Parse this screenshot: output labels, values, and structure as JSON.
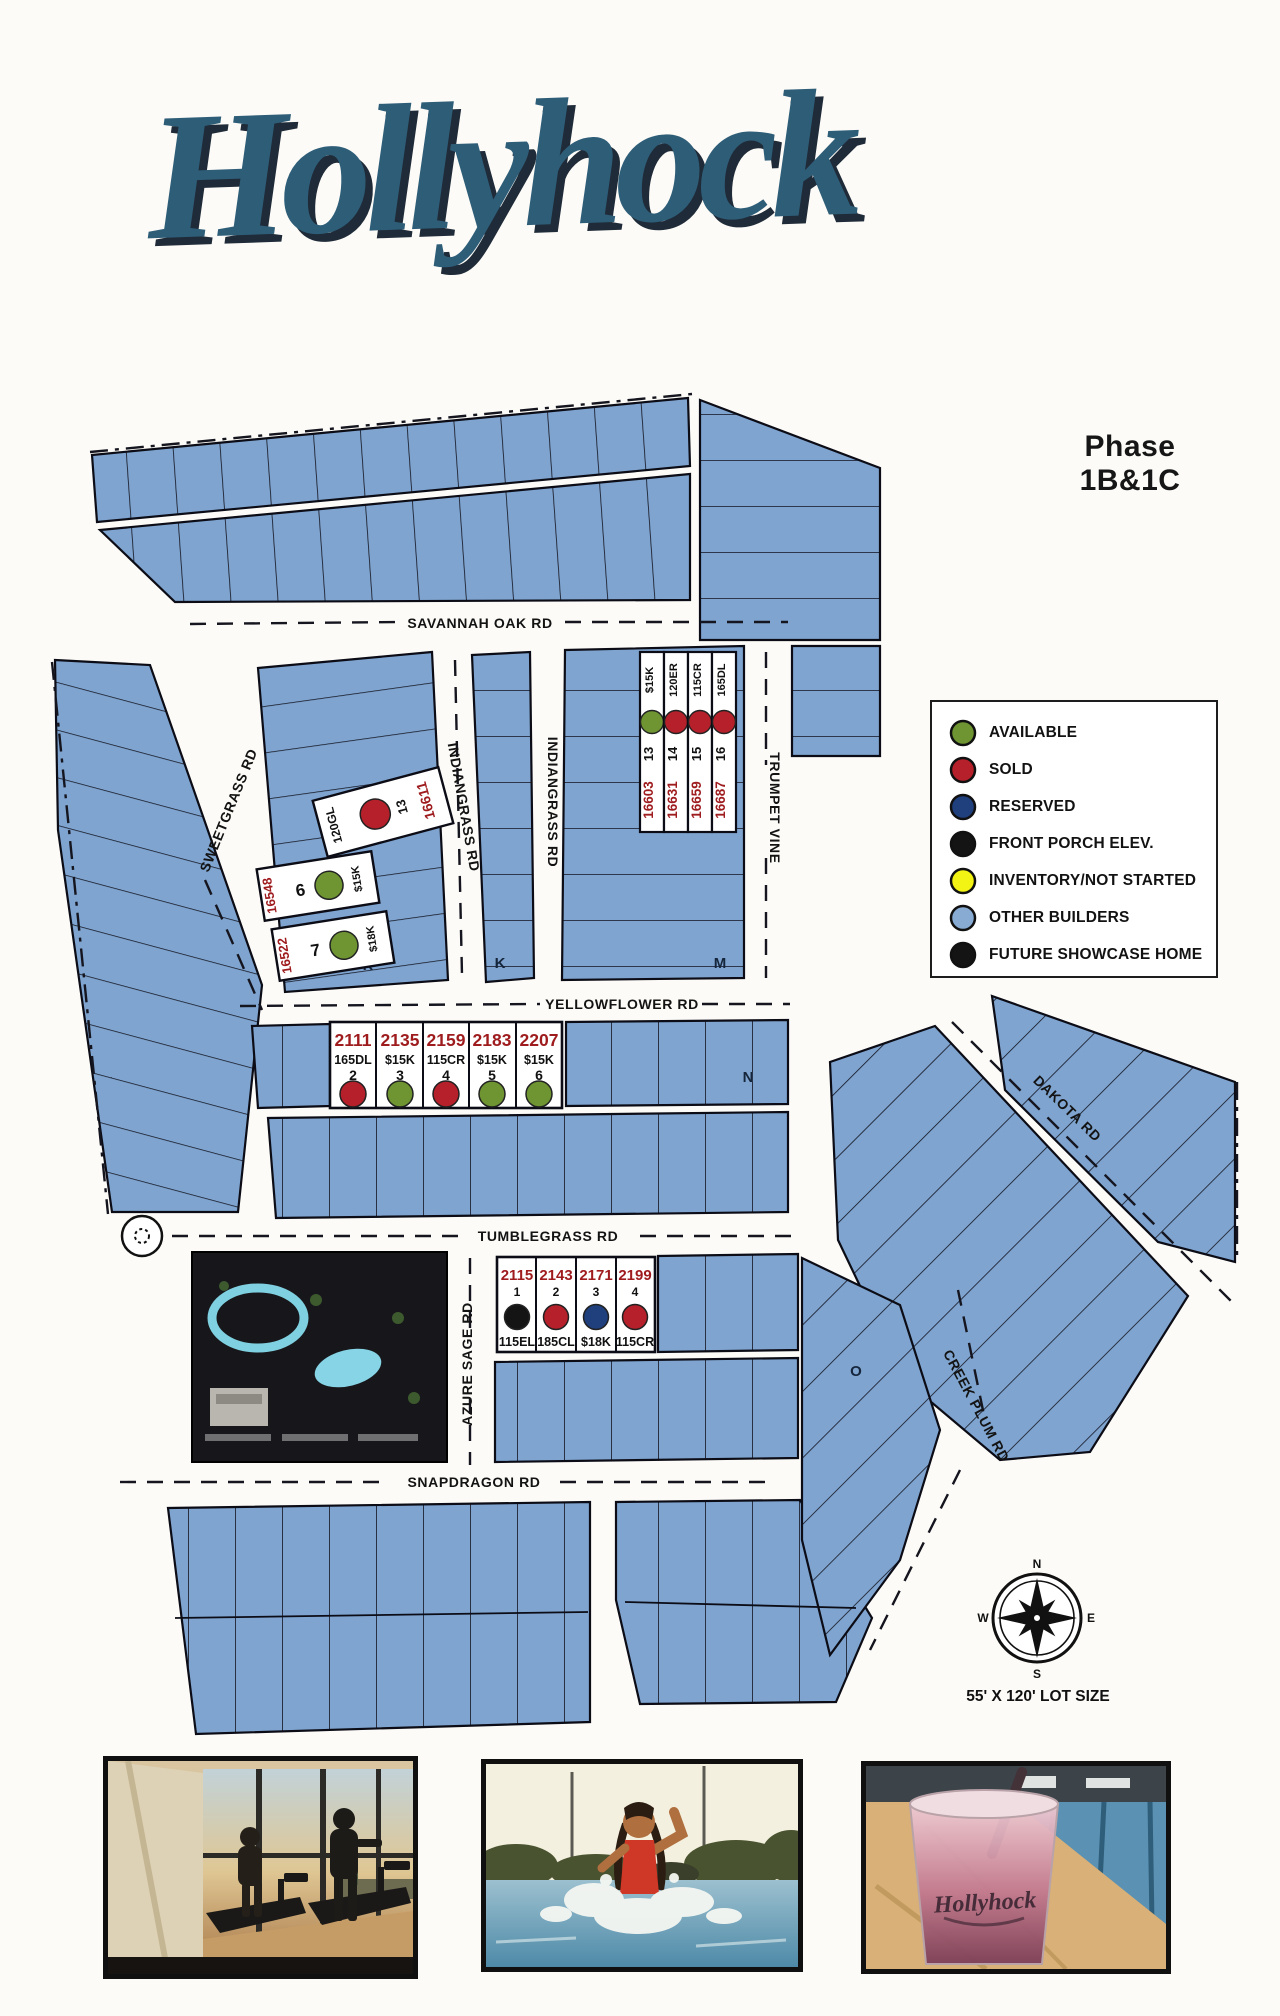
{
  "header": {
    "title": "Hollyhock",
    "phase": "Phase 1B&1C"
  },
  "legend": {
    "items": [
      {
        "label": "AVAILABLE",
        "color": "#6e9531"
      },
      {
        "label": "SOLD",
        "color": "#b5202a"
      },
      {
        "label": "RESERVED",
        "color": "#1f3f7d"
      },
      {
        "label": "FRONT PORCH ELEV.",
        "color": "#141414"
      },
      {
        "label": "INVENTORY/NOT STARTED",
        "color": "#f4f414"
      },
      {
        "label": "OTHER BUILDERS",
        "color": "#88abd3"
      },
      {
        "label": "FUTURE SHOWCASE HOME",
        "color": "#141414"
      }
    ]
  },
  "map": {
    "streets": {
      "savannah_oak": "SAVANNAH OAK RD",
      "sweetgrass": "SWEETGRASS RD",
      "indiangrass": "INDIANGRASS RD",
      "trumpet_vine": "TRUMPET VINE",
      "yellowflower": "YELLOWFLOWER RD",
      "tumblegrass": "TUMBLEGRASS RD",
      "azure_sage": "AZURE SAGE RD",
      "snapdragon": "SNAPDRAGON RD",
      "dakota": "DAKOTA RD",
      "creek_plum": "CREEK PLUM RD"
    },
    "sections": [
      "K",
      "K",
      "M",
      "N",
      "O"
    ],
    "compass": {
      "n": "N",
      "e": "E",
      "s": "S",
      "w": "W"
    },
    "lot_size_note": "55' X 120' LOT SIZE"
  },
  "featured_lots": {
    "sweetgrass_cluster": [
      {
        "plan": "120GL",
        "num": "13",
        "addr": "16611",
        "status": "SOLD",
        "color": "#b5202a"
      },
      {
        "plan": "$15K",
        "num": "6",
        "addr": "16548",
        "status": "AVAILABLE",
        "color": "#6e9531"
      },
      {
        "plan": "$18K",
        "num": "7",
        "addr": "16522",
        "status": "AVAILABLE",
        "color": "#6e9531"
      }
    ],
    "trumpet_cluster": [
      {
        "plan": "$15K",
        "num": "13",
        "addr": "16603",
        "status": "AVAILABLE",
        "color": "#6e9531"
      },
      {
        "plan": "120ER",
        "num": "14",
        "addr": "16631",
        "status": "SOLD",
        "color": "#b5202a"
      },
      {
        "plan": "115CR",
        "num": "15",
        "addr": "16659",
        "status": "SOLD",
        "color": "#b5202a"
      },
      {
        "plan": "165DL",
        "num": "16",
        "addr": "16687",
        "status": "SOLD",
        "color": "#b5202a"
      }
    ],
    "yellowflower_row": [
      {
        "addr": "2111",
        "plan": "165DL",
        "num": "2",
        "status": "SOLD",
        "color": "#b5202a"
      },
      {
        "addr": "2135",
        "plan": "$15K",
        "num": "3",
        "status": "AVAILABLE",
        "color": "#6e9531"
      },
      {
        "addr": "2159",
        "plan": "115CR",
        "num": "4",
        "status": "SOLD",
        "color": "#b5202a"
      },
      {
        "addr": "2183",
        "plan": "$15K",
        "num": "5",
        "status": "AVAILABLE",
        "color": "#6e9531"
      },
      {
        "addr": "2207",
        "plan": "$15K",
        "num": "6",
        "status": "AVAILABLE",
        "color": "#6e9531"
      }
    ],
    "tumblegrass_row": [
      {
        "addr": "2115",
        "num": "1",
        "plan": "115EL",
        "status": "FRONT PORCH ELEV.",
        "color": "#141414"
      },
      {
        "addr": "2143",
        "num": "2",
        "plan": "185CL",
        "status": "SOLD",
        "color": "#b5202a"
      },
      {
        "addr": "2171",
        "num": "3",
        "plan": "$18K",
        "status": "RESERVED",
        "color": "#1f3f7d"
      },
      {
        "addr": "2199",
        "num": "4",
        "plan": "115CR",
        "status": "SOLD",
        "color": "#b5202a"
      }
    ]
  },
  "photos": {
    "cup_text": "Hollyhock"
  }
}
